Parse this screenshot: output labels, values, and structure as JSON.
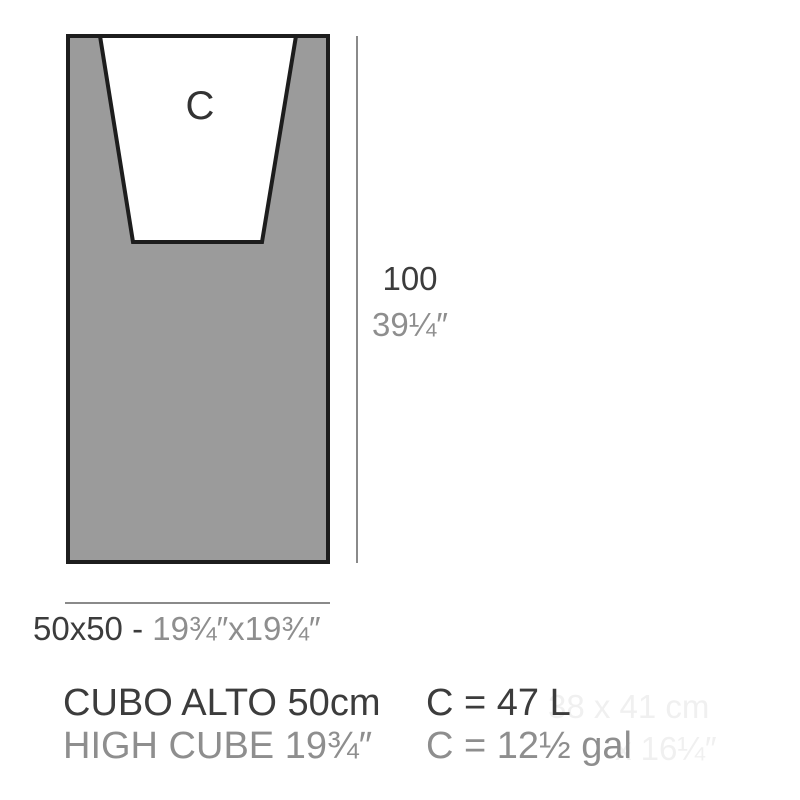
{
  "diagram": {
    "cavity_label": "C",
    "height": {
      "cm": "100",
      "inches": "39¼″"
    },
    "base": {
      "cm": "50x50 - ",
      "inches": "19¾″x19¾″"
    }
  },
  "product": {
    "name_metric": "CUBO ALTO 50cm",
    "name_imperial": "HIGH CUBE 19¾″",
    "capacity_liters": "C = 47 L",
    "capacity_gallons": "C = 12½ gal"
  },
  "watermark": {
    "line1": "38 x 41 cm",
    "line2": "x 16¼″"
  },
  "colors": {
    "body_fill": "#9b9b9b",
    "outline": "#1d1d1d",
    "cavity_fill": "#ffffff",
    "dim_line": "#8a8a8a",
    "text_dark": "#3c3c3c",
    "text_light": "#8e8e8e",
    "watermark": "#f0f0f0"
  }
}
